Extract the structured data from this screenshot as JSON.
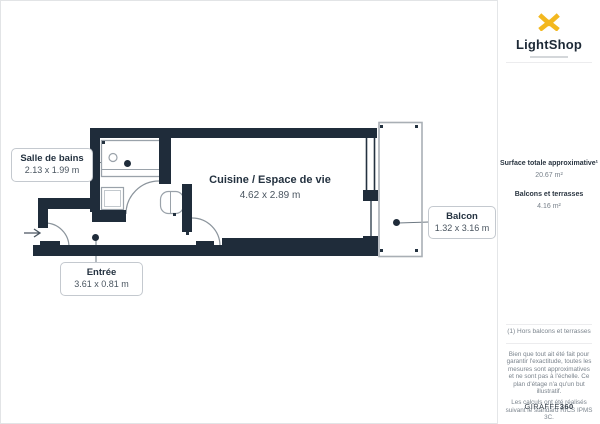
{
  "header": {
    "brand": "LightShop"
  },
  "floorplan": {
    "labels": {
      "bathroom": {
        "name": "Salle de bains",
        "dims": "2.13 x 1.99 m"
      },
      "kitchen": {
        "name": "Cuisine / Espace de vie",
        "dims": "4.62 x 2.89 m"
      },
      "balcony": {
        "name": "Balcon",
        "dims": "1.32 x 3.16 m"
      },
      "entrance": {
        "name": "Entrée",
        "dims": "3.61 x 0.81 m"
      }
    }
  },
  "sidebar": {
    "surface_title": "Surface totale approximative¹",
    "surface_value": "20.67 m²",
    "balcony_title": "Balcons et terrasses",
    "balcony_value": "4.16 m²",
    "footnote": "(1) Hors balcons et terrasses",
    "disclaimer_1": "Bien que tout ait été fait pour garantir l'exactitude, toutes les mesures sont approximatives et ne sont pas à l'échelle. Ce plan d'étage n'a qu'un but illustratif.",
    "disclaimer_2": "Les calculs ont été réalisés suivant le standard RICS IPMS 3C.",
    "credit_brand": "GIRAFFE",
    "credit_suffix": "360"
  },
  "colors": {
    "wall": "#1f2c3a",
    "gold": "#f3b81f",
    "line": "#9aa2aa"
  }
}
